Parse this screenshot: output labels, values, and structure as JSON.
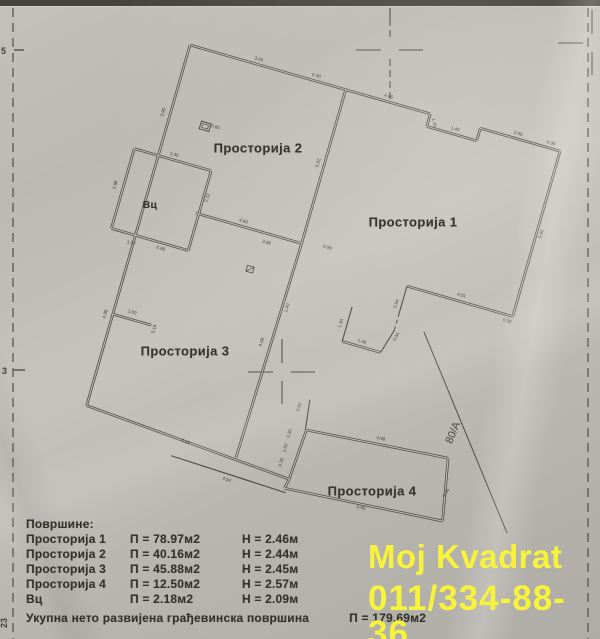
{
  "plan": {
    "rotation_deg": 16,
    "origin": [
      190,
      45
    ],
    "ink": "#4a4743",
    "paper_line": "#bdbab4",
    "mark_color": "#514d47",
    "walls_double": [
      [
        0,
        0,
        250,
        0
      ],
      [
        250,
        0,
        250,
        13
      ],
      [
        250,
        13,
        302,
        13
      ],
      [
        302,
        13,
        302,
        0
      ],
      [
        302,
        0,
        385,
        0
      ],
      [
        0,
        0,
        0,
        375
      ],
      [
        385,
        0,
        385,
        172
      ],
      [
        385,
        172,
        275,
        172
      ],
      [
        268,
        243,
        228,
        243
      ],
      [
        162,
        0,
        162,
        160
      ],
      [
        52,
        160,
        162,
        160
      ],
      [
        162,
        160,
        158,
        384
      ],
      [
        0,
        375,
        215,
        390
      ],
      [
        218,
        338,
        362,
        326
      ],
      [
        362,
        326,
        374,
        388
      ],
      [
        374,
        388,
        213,
        400
      ],
      [
        215,
        390,
        218,
        338
      ],
      [
        215,
        390,
        213,
        400
      ],
      [
        -25,
        115,
        55,
        115
      ],
      [
        -25,
        115,
        -25,
        198
      ],
      [
        -25,
        198,
        55,
        198
      ],
      [
        55,
        115,
        55,
        198
      ],
      [
        0,
        280,
        40,
        280
      ]
    ],
    "walls_single": [
      [
        275,
        172,
        275,
        200
      ],
      [
        275,
        218,
        268,
        243
      ],
      [
        228,
        243,
        228,
        207
      ],
      [
        213,
        308,
        217,
        338
      ],
      [
        95,
        400,
        215,
        404
      ]
    ],
    "walls_dashed": [
      [
        275,
        200,
        275,
        218
      ]
    ],
    "rooms": [
      {
        "label": "Просторија 2",
        "x": 258,
        "y": 148,
        "size": 13
      },
      {
        "label": "Просторија 1",
        "x": 413,
        "y": 222,
        "size": 13
      },
      {
        "label": "Просторија 3",
        "x": 185,
        "y": 351,
        "size": 13
      },
      {
        "label": "Просторија 4",
        "x": 372,
        "y": 491,
        "size": 13
      },
      {
        "label": "Вц",
        "x": 150,
        "y": 205,
        "size": 10.5
      }
    ],
    "dims": [
      {
        "t": "3.95",
        "x": 70,
        "y": -4,
        "r": 0
      },
      {
        "t": "0.30",
        "x": 130,
        "y": -4,
        "r": 0
      },
      {
        "t": "4.65",
        "x": 205,
        "y": -4,
        "r": 0
      },
      {
        "t": "1.10",
        "x": 255,
        "y": 8,
        "r": 60
      },
      {
        "t": "1.40",
        "x": 278,
        "y": 9,
        "r": 0
      },
      {
        "t": "2.95",
        "x": 340,
        "y": -4,
        "r": 0
      },
      {
        "t": "0.30",
        "x": 374,
        "y": -4,
        "r": 0
      },
      {
        "t": "5.90",
        "x": 391,
        "y": 85,
        "r": -90
      },
      {
        "t": "4.01",
        "x": 330,
        "y": 167,
        "r": 0
      },
      {
        "t": "0.30",
        "x": 381,
        "y": 179,
        "r": 0
      },
      {
        "t": "0.94",
        "x": 271,
        "y": 192,
        "r": -85
      },
      {
        "t": "0.34",
        "x": 280,
        "y": 224,
        "r": -80
      },
      {
        "t": "1.46",
        "x": 247,
        "y": 239,
        "r": 0
      },
      {
        "t": "1.30",
        "x": 223,
        "y": 226,
        "r": -90
      },
      {
        "t": "5.82",
        "x": 157,
        "y": 78,
        "r": -90
      },
      {
        "t": "4.60",
        "x": 100,
        "y": 156,
        "r": 0
      },
      {
        "t": "3.86",
        "x": 128,
        "y": 170,
        "r": 0
      },
      {
        "t": "0.90",
        "x": 188,
        "y": 158,
        "r": 0
      },
      {
        "t": "3.90",
        "x": -6,
        "y": 72,
        "r": -90
      },
      {
        "t": "4.99",
        "x": -6,
        "y": 282,
        "r": -90
      },
      {
        "t": "1.00",
        "x": 18,
        "y": 274,
        "r": 0
      },
      {
        "t": "0.18",
        "x": 45,
        "y": 283,
        "r": -90
      },
      {
        "t": "5.99",
        "x": 105,
        "y": 384,
        "r": 4
      },
      {
        "t": "0.98",
        "x": -32,
        "y": 155,
        "r": -90
      },
      {
        "t": "1.40",
        "x": 15,
        "y": 111,
        "r": 0
      },
      {
        "t": "2.22",
        "x": 60,
        "y": 142,
        "r": -90
      },
      {
        "t": "0.90",
        "x": 28,
        "y": 205,
        "r": 0
      },
      {
        "t": "1.57",
        "x": -2,
        "y": 208,
        "r": 0
      },
      {
        "t": "0.60",
        "x": 47,
        "y": 73,
        "r": 0
      },
      {
        "t": "4.08",
        "x": 152,
        "y": 266,
        "r": -87
      },
      {
        "t": "1.40",
        "x": 167,
        "y": 226,
        "r": -90
      },
      {
        "t": "2.92",
        "x": 206,
        "y": 318,
        "r": -88
      },
      {
        "t": "0.30",
        "x": 204,
        "y": 346,
        "r": -90
      },
      {
        "t": "1.50",
        "x": 204,
        "y": 361,
        "r": -90
      },
      {
        "t": "0.30",
        "x": 204,
        "y": 376,
        "r": -90
      },
      {
        "t": "4.96",
        "x": 292,
        "y": 327,
        "r": -4
      },
      {
        "t": "2.45",
        "x": 371,
        "y": 360,
        "r": -80
      },
      {
        "t": "4.90",
        "x": 292,
        "y": 399,
        "r": -4
      },
      {
        "t": "4.94",
        "x": 155,
        "y": 409,
        "r": 4
      }
    ],
    "fixtures": [
      {
        "type": "panel",
        "x": 32,
        "y": 70
      },
      {
        "type": "door",
        "x": 116,
        "y": 196
      }
    ],
    "boundary_line": {
      "x1": 424,
      "y1": 332,
      "x2": 507,
      "y2": 533,
      "label": "80/A",
      "lx": 456,
      "ly": 434,
      "lr": -67
    },
    "crosses": [
      {
        "x": 390,
        "y": 50,
        "long_v": true
      },
      {
        "x": 592,
        "y": 43,
        "long_v": false
      },
      {
        "x": 282,
        "y": 372,
        "long_v": false
      }
    ],
    "frame": {
      "left_x": 13,
      "right_x": 588,
      "ticks": [
        [
          14,
          50,
          24,
          50
        ],
        [
          14,
          370,
          25,
          370
        ]
      ],
      "edge_labels": [
        {
          "t": "5",
          "x": 1,
          "y": 54,
          "r": 0
        },
        {
          "t": "3",
          "x": 2,
          "y": 374,
          "r": 0
        },
        {
          "t": "23",
          "x": 7,
          "y": 628,
          "r": -90
        }
      ]
    }
  },
  "legend": {
    "title": "Површине:",
    "rows": [
      {
        "name": "Просторија 1",
        "p": "П = 78.97м2",
        "h": "Н = 2.46м"
      },
      {
        "name": "Просторија 2",
        "p": "П = 40.16м2",
        "h": "Н = 2.44м"
      },
      {
        "name": "Просторија 3",
        "p": "П = 45.88м2",
        "h": "Н = 2.45м"
      },
      {
        "name": "Просторија 4",
        "p": "П = 12.50м2",
        "h": "Н = 2.57м"
      },
      {
        "name": "Вц",
        "p": "П =  2.18м2",
        "h": "Н = 2.09м"
      }
    ],
    "total_label": "Укупна нето развијена грађевинска површина",
    "total_value": "П = 179.69м2"
  },
  "watermark": {
    "line1": "Moj Kvadrat",
    "line2": "011/334-88-36",
    "color": "#f7f33b"
  }
}
